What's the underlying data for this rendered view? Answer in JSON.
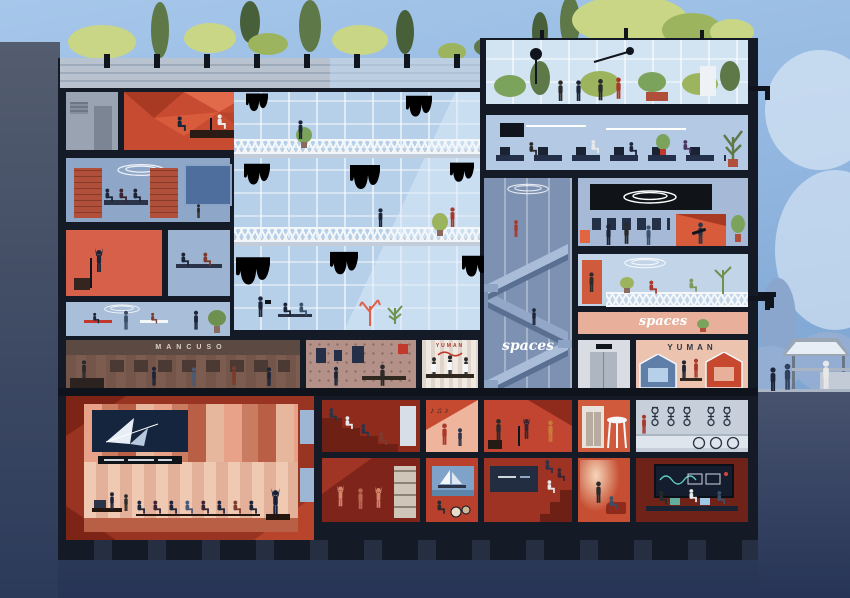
{
  "scene": {
    "title": "building-cross-section-illustration",
    "signs": {
      "mancuso": "MANCUSO",
      "yuman_store": "YUMAN",
      "yuman_lounge": "YUMAN",
      "spaces_core": "spaces",
      "spaces_lounge": "spaces"
    },
    "decor": {
      "music_notes": "♪ ♫ ♪"
    }
  },
  "palette": {
    "skyTop": "#a6c7ea",
    "skyMid": "#8fb4de",
    "skyLow": "#7ea6d2",
    "cloud": "#d4e3f3",
    "bush": "#93aed2",
    "bushDark": "#8aa6cc",
    "groundTop": "#47536e",
    "groundBot": "#273456",
    "wallTop": "#545d6f",
    "wallBot": "#2c3a5a",
    "frame": "#141a26",
    "concrete": "#c3cdd9",
    "parapet": "#b9c3d0",
    "parapetLine": "#9dabbb",
    "glass": "#b7d0ea",
    "glassLight": "#d2e3f2",
    "roomBlue": "#8ea6c8",
    "roomBlueLight": "#b3c9e4",
    "roomBluePale": "#c2d4e8",
    "utility": "#9aa3b1",
    "redMain": "#c74b30",
    "redDeep": "#8e2b1d",
    "redDark": "#7e241a",
    "redBright": "#d6604a",
    "redOrange": "#cf5a3c",
    "salmon": "#e8b09b",
    "salmonLight": "#eec0a8",
    "salmonPale": "#ecc3ae",
    "brown": "#7d5c50",
    "brownDark": "#5c4a42",
    "techWall": "#b39189",
    "brick": "#b0503a",
    "greenLight": "#c9d685",
    "greenMid": "#9db45e",
    "greenDark": "#5f7848",
    "greenDeep": "#48603a",
    "moss": "#8fae5c",
    "mossDark": "#76994e",
    "navy": "#1c2438",
    "white": "#f4f7fa",
    "screenNavy": "#16253e",
    "signBlack": "#101418",
    "teal": "#5fd0c0"
  }
}
